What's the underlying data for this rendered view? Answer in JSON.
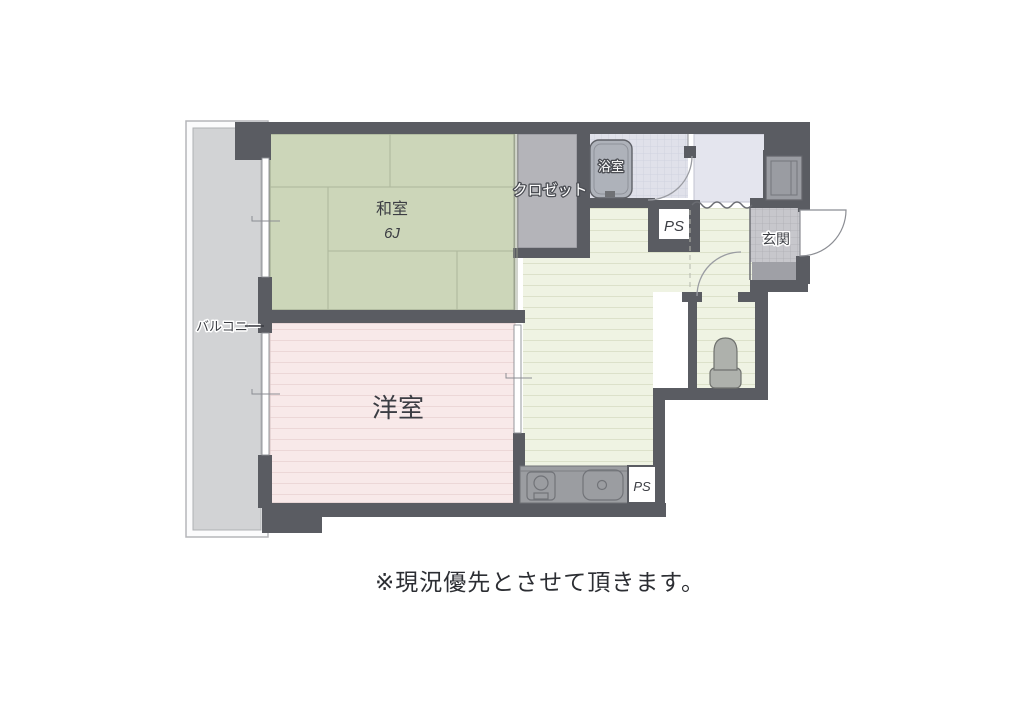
{
  "floorplan": {
    "rooms": {
      "balcony": {
        "label": "バルコニー"
      },
      "japanese_room": {
        "label": "和室",
        "size": "6J"
      },
      "western_room": {
        "label": "洋室"
      },
      "closet": {
        "label": "クロゼット"
      },
      "bathroom": {
        "label": "浴室"
      },
      "entrance": {
        "label": "玄関"
      },
      "pipe_space_upper": {
        "label": "PS"
      },
      "pipe_space_lower": {
        "label": "PS"
      }
    },
    "note": "※現況優先とさせて頂きます。",
    "colors": {
      "wall": "#5a5c62",
      "tatami_green": "#ccd6b9",
      "western_room_pink": "#f8e9e9",
      "flooring_green": "#eff3e3",
      "balcony_gray": "#d2d3d5",
      "closet_gray": "#b4b4b9",
      "bathroom_lavender": "#e0e1ea",
      "washroom_lavender": "#e4e5ee",
      "entrance_grid_gray": "#c7c7cc",
      "fixture_gray": "#9b9da1",
      "background": "#ffffff"
    }
  }
}
